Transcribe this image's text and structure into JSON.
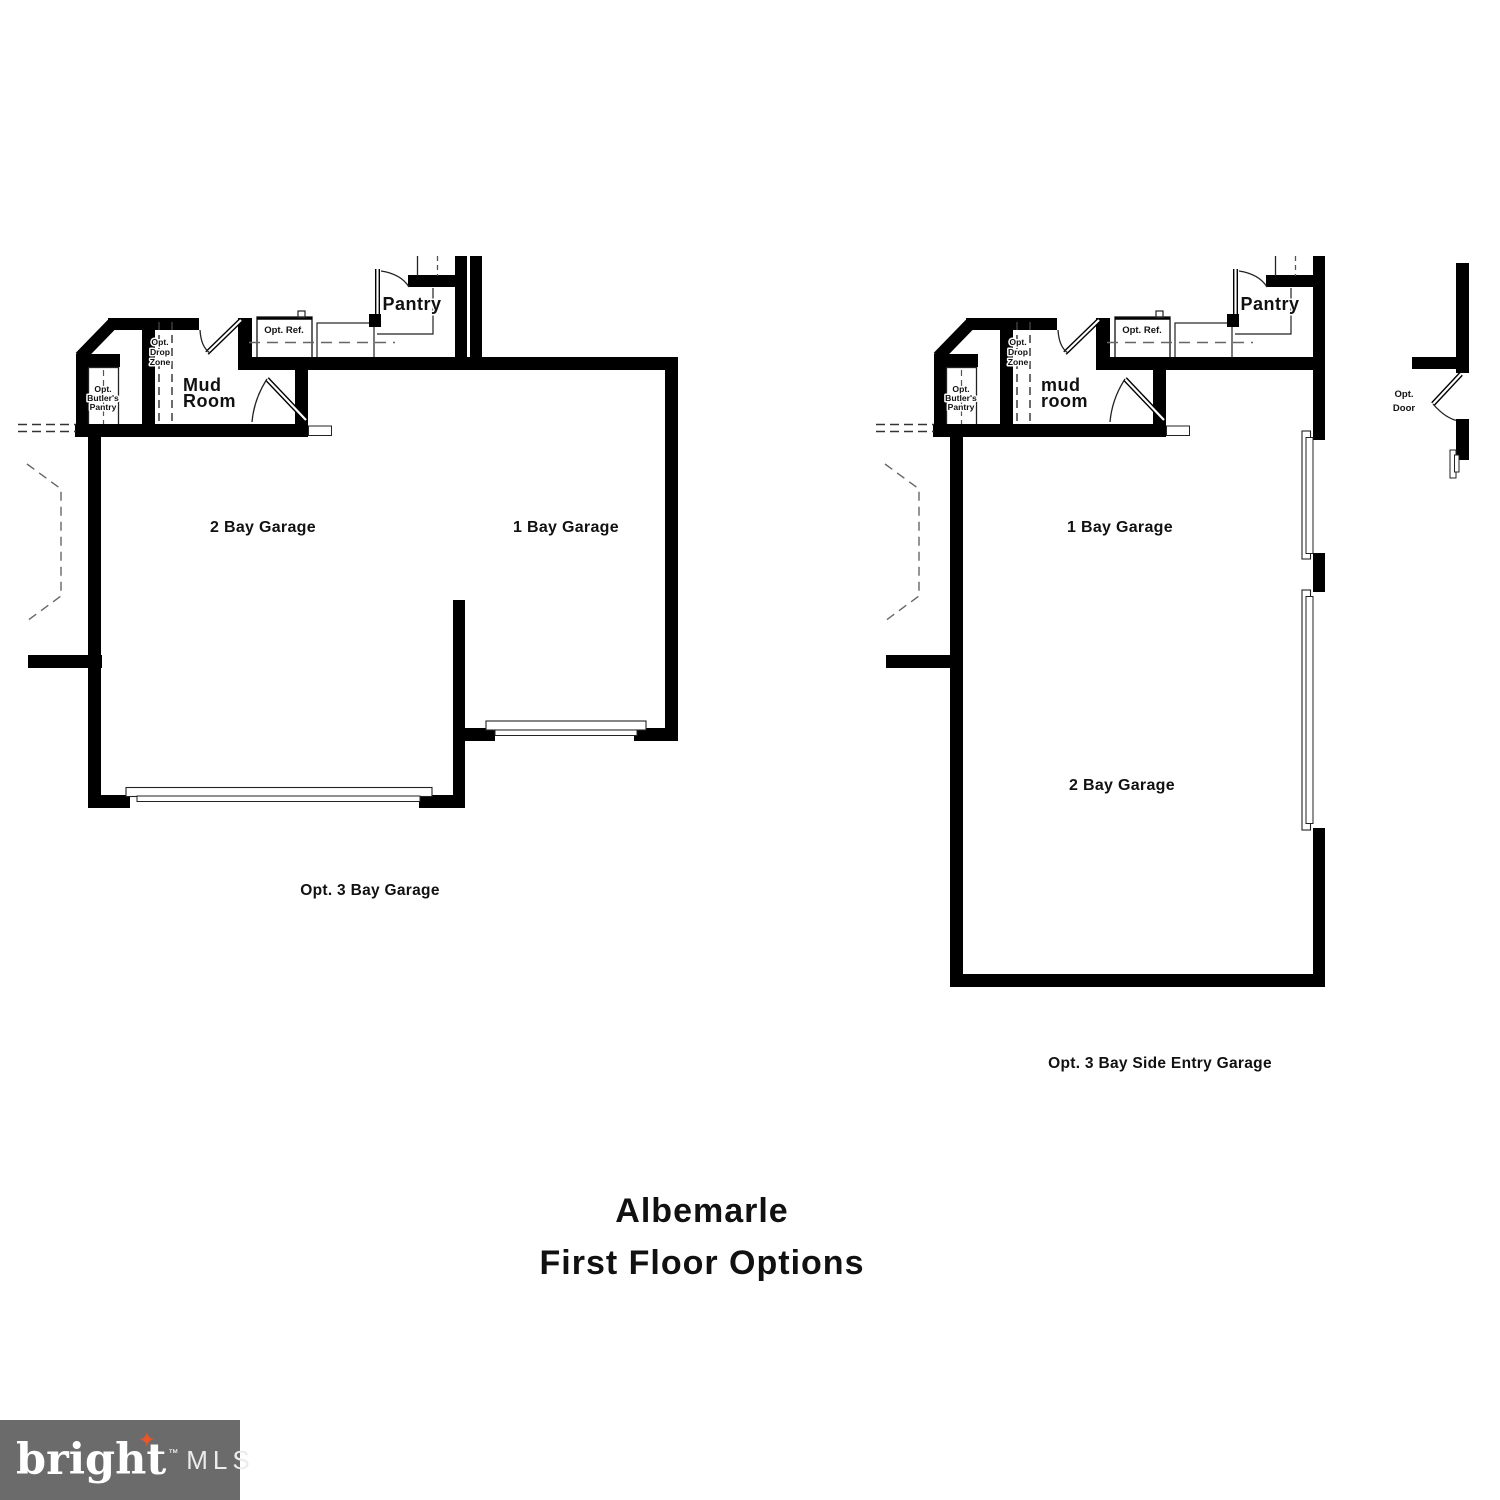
{
  "colors": {
    "wall": "#000000",
    "thin_line": "#222222",
    "dashed_line": "#666666",
    "text": "#111111",
    "logo_bg": "#6b6b6b",
    "logo_star": "#e8562a"
  },
  "title": {
    "line1": "Albemarle",
    "line2": "First Floor Options"
  },
  "plans": {
    "left": {
      "caption": "Opt. 3 Bay Garage",
      "rooms": {
        "pantry": "Pantry",
        "opt_ref": "Opt. Ref.",
        "drop_zone": [
          "Opt.",
          "Drop",
          "Zone"
        ],
        "butlers_pantry": [
          "Opt.",
          "Butler's",
          "Pantry"
        ],
        "mud_room": [
          "Mud",
          "Room"
        ],
        "garage_2bay": "2 Bay Garage",
        "garage_1bay": "1 Bay Garage"
      }
    },
    "right": {
      "caption": "Opt. 3 Bay Side Entry Garage",
      "rooms": {
        "pantry": "Pantry",
        "opt_ref": "Opt. Ref.",
        "drop_zone": [
          "Opt.",
          "Drop",
          "Zone"
        ],
        "butlers_pantry": [
          "Opt.",
          "Butler's",
          "Pantry"
        ],
        "mud_room": [
          "mud",
          "room"
        ],
        "garage_1bay": "1 Bay Garage",
        "garage_2bay": "2 Bay Garage"
      },
      "opt_door": [
        "Opt.",
        "Door"
      ]
    }
  },
  "logo": {
    "brand": "bright",
    "tm": "™",
    "suffix": "MLS",
    "star_glyph": "✦"
  }
}
